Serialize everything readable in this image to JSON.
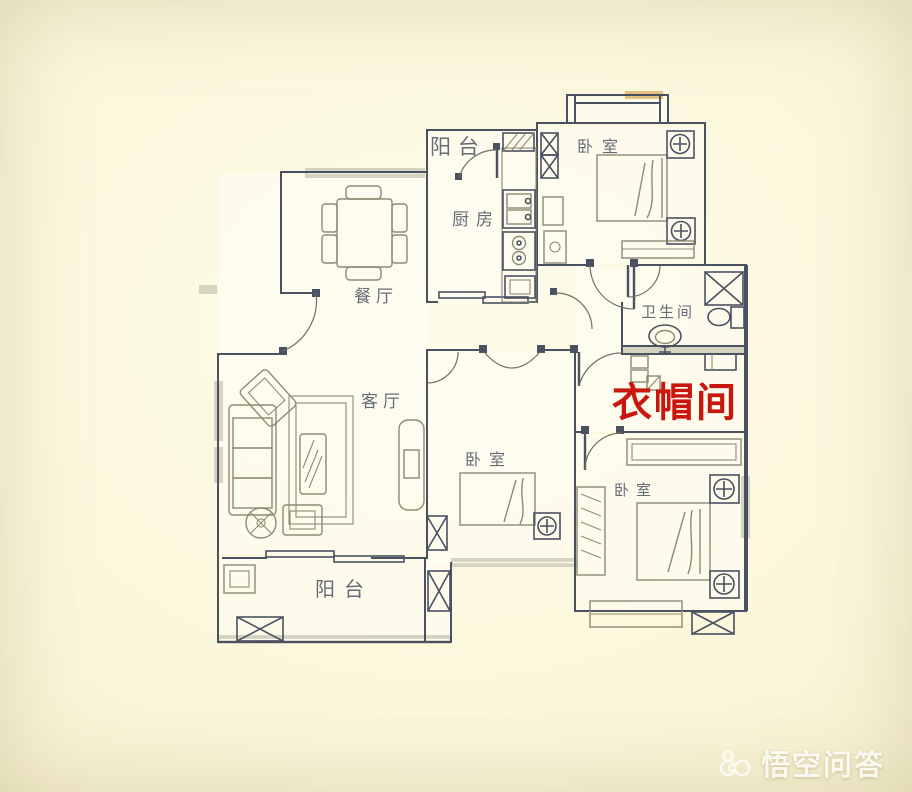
{
  "colors": {
    "wall-line": "#4a5161",
    "furniture-line": "#8d8b74",
    "door-line": "#6f7263",
    "wall-band": "#d6d3c0",
    "accent-red": "#c9170e",
    "label-text": "#595f6d",
    "paper-light": "#fefce9",
    "paper-dark": "#e9e2ba"
  },
  "rooms": [
    {
      "id": "balcony-top",
      "label": "阳台"
    },
    {
      "id": "bedroom-top-right",
      "label": "卧室"
    },
    {
      "id": "kitchen",
      "label": "厨房"
    },
    {
      "id": "dining-room",
      "label": "餐厅"
    },
    {
      "id": "bathroom",
      "label": "卫生间"
    },
    {
      "id": "living-room",
      "label": "客厅"
    },
    {
      "id": "bedroom-middle",
      "label": "卧室"
    },
    {
      "id": "bedroom-bottom-right",
      "label": "卧室"
    },
    {
      "id": "balcony-bottom",
      "label": "阳台"
    }
  ],
  "annotation": {
    "label": "衣帽间",
    "color": "#c9170e"
  },
  "watermark": {
    "text": "悟空问答",
    "icon": "wukong-cloud-logo"
  }
}
